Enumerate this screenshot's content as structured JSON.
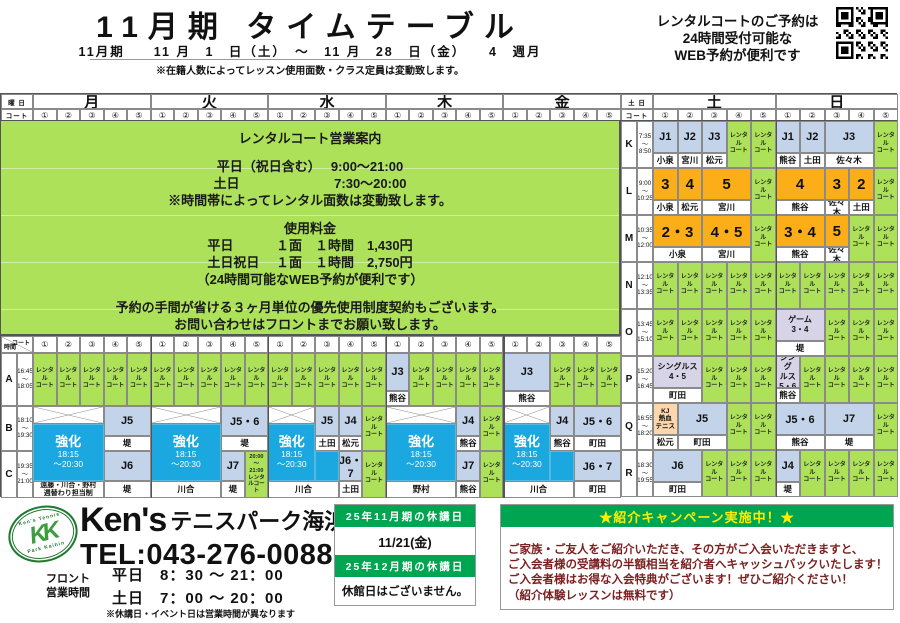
{
  "header": {
    "title": "11月期 タイムテーブル",
    "subtitle": "11月期　　11 月　1　日（土）　～　11 月　28　日（金）　　4　週月",
    "capacity_note": "※在籍人数によってレッスン使用面数・クラス定員は変動致します。",
    "web_note_lines": [
      "レンタルコートのご予約は",
      "24時間受付可能な",
      "WEB予約が便利です"
    ]
  },
  "table_header": {
    "corner_top": "曜 日",
    "corner_bottom": "コート",
    "weekdays": [
      "月",
      "火",
      "水",
      "木",
      "金"
    ],
    "weekend_corner": "土 日",
    "weekend_days": [
      "土",
      "日"
    ],
    "courts": [
      "①",
      "②",
      "③",
      "④",
      "⑤"
    ]
  },
  "green_info": {
    "lines": [
      "レンタルコート営業案内",
      "",
      "平日（祝日含む）　 9:00～21:00",
      "土日　　　　　　　 7:30～20:00",
      "※時間帯によってレンタル面数は変動致します。",
      "",
      "使用料金",
      "平日　　　 １面　１時間　1,430円",
      "土日祝日　 １面　１時間　2,750円",
      "（24時間可能なWEB予約が便利です）",
      "",
      "予約の手間が省ける３ヶ月単位の優先使用制度契約もございます。",
      "お問い合わせはフロントまでお願い致します。"
    ]
  },
  "weekend": {
    "rental_label": "レンタル|コート",
    "rows": [
      {
        "label": "K",
        "t1": "7:35",
        "t2": "8:50",
        "sat": [
          {
            "s": 1,
            "c": "class",
            "t": "J1",
            "n": "小泉"
          },
          {
            "s": 1,
            "c": "class",
            "t": "J2",
            "n": "宮川"
          },
          {
            "s": 1,
            "c": "class",
            "t": "J3",
            "n": "松元"
          },
          {
            "s": 1,
            "c": "rental"
          },
          {
            "s": 1,
            "c": "rental"
          }
        ],
        "sun": [
          {
            "s": 1,
            "c": "class",
            "t": "J1",
            "n": "熊谷"
          },
          {
            "s": 1,
            "c": "class",
            "t": "J2",
            "n": "土田"
          },
          {
            "s": 2,
            "c": "class",
            "t": "J3",
            "n": "佐々木"
          },
          {
            "s": 1,
            "c": "rental"
          }
        ]
      },
      {
        "label": "L",
        "t1": "9:00",
        "t2": "10:25",
        "sat": [
          {
            "s": 1,
            "c": "num",
            "t": "3",
            "n": "小泉"
          },
          {
            "s": 1,
            "c": "num",
            "t": "4",
            "n": "松元"
          },
          {
            "s": 2,
            "c": "num",
            "t": "5",
            "n": "宮川"
          },
          {
            "s": 1,
            "c": "rental"
          }
        ],
        "sun": [
          {
            "s": 2,
            "c": "num",
            "t": "4",
            "n": "熊谷"
          },
          {
            "s": 1,
            "c": "num",
            "t": "3",
            "n": "佐々木"
          },
          {
            "s": 1,
            "c": "num",
            "t": "2",
            "n": "土田"
          },
          {
            "s": 1,
            "c": "rental"
          }
        ]
      },
      {
        "label": "M",
        "t1": "10:35",
        "t2": "12:00",
        "sat": [
          {
            "s": 2,
            "c": "num",
            "t": "2・3",
            "n": "小泉"
          },
          {
            "s": 2,
            "c": "num",
            "t": "4・5",
            "n": "宮川"
          },
          {
            "s": 1,
            "c": "rental"
          }
        ],
        "sun": [
          {
            "s": 2,
            "c": "num",
            "t": "3・4",
            "n": "熊谷"
          },
          {
            "s": 1,
            "c": "num",
            "t": "5",
            "n": "佐々木"
          },
          {
            "s": 1,
            "c": "rental"
          },
          {
            "s": 1,
            "c": "rental"
          }
        ]
      },
      {
        "label": "N",
        "t1": "12:10",
        "t2": "13:35",
        "sat": [
          {
            "s": 1,
            "c": "rental"
          },
          {
            "s": 1,
            "c": "rental"
          },
          {
            "s": 1,
            "c": "rental"
          },
          {
            "s": 1,
            "c": "rental"
          },
          {
            "s": 1,
            "c": "rental"
          }
        ],
        "sun": [
          {
            "s": 1,
            "c": "rental"
          },
          {
            "s": 1,
            "c": "rental"
          },
          {
            "s": 1,
            "c": "rental"
          },
          {
            "s": 1,
            "c": "rental"
          },
          {
            "s": 1,
            "c": "rental"
          }
        ]
      },
      {
        "label": "O",
        "t1": "13:45",
        "t2": "15:10",
        "sat": [
          {
            "s": 1,
            "c": "rental"
          },
          {
            "s": 1,
            "c": "rental"
          },
          {
            "s": 1,
            "c": "rental"
          },
          {
            "s": 1,
            "c": "rental"
          },
          {
            "s": 1,
            "c": "rental"
          }
        ],
        "sun": [
          {
            "s": 2,
            "c": "game",
            "t": "ゲーム|3・4",
            "n": "堤"
          },
          {
            "s": 1,
            "c": "rental"
          },
          {
            "s": 1,
            "c": "rental"
          },
          {
            "s": 1,
            "c": "rental"
          }
        ]
      },
      {
        "label": "P",
        "t1": "15:20",
        "t2": "16:45",
        "sat": [
          {
            "s": 2,
            "c": "game",
            "t": "シングルス|4・5",
            "n": "町田"
          },
          {
            "s": 1,
            "c": "rental"
          },
          {
            "s": 1,
            "c": "rental"
          },
          {
            "s": 1,
            "c": "rental"
          }
        ],
        "sun": [
          {
            "s": 1,
            "c": "game",
            "t": "シング|ルス|5・6",
            "n": "熊谷"
          },
          {
            "s": 1,
            "c": "rental"
          },
          {
            "s": 1,
            "c": "rental"
          },
          {
            "s": 1,
            "c": "rental"
          },
          {
            "s": 1,
            "c": "rental"
          }
        ]
      },
      {
        "label": "Q",
        "t1": "16:55",
        "t2": "18:20",
        "sat": [
          {
            "s": 1,
            "c": "kj",
            "t": "KJ|熱血|テニス",
            "n": "松元"
          },
          {
            "s": 2,
            "c": "class",
            "t": "J5",
            "n": "町田"
          },
          {
            "s": 1,
            "c": "rental"
          },
          {
            "s": 1,
            "c": "rental"
          }
        ],
        "sun": [
          {
            "s": 2,
            "c": "class",
            "t": "J5・6",
            "n": "熊谷"
          },
          {
            "s": 2,
            "c": "class",
            "t": "J7",
            "n": "堤"
          },
          {
            "s": 1,
            "c": "rental"
          }
        ]
      },
      {
        "label": "R",
        "t1": "18:30",
        "t2": "19:55",
        "sat": [
          {
            "s": 2,
            "c": "class",
            "t": "J6",
            "n": "町田"
          },
          {
            "s": 1,
            "c": "rental"
          },
          {
            "s": 1,
            "c": "rental"
          },
          {
            "s": 1,
            "c": "rental"
          }
        ],
        "sun": [
          {
            "s": 1,
            "c": "class",
            "t": "J4",
            "n": "堤"
          },
          {
            "s": 1,
            "c": "rental"
          },
          {
            "s": 1,
            "c": "rental"
          },
          {
            "s": 1,
            "c": "rental"
          },
          {
            "s": 1,
            "c": "rental"
          }
        ]
      }
    ]
  },
  "bottom_table": {
    "corner_time": "時間",
    "corner_court": "コート",
    "kyoka_title": "強化",
    "kyoka_time": "18:15|～20:30",
    "rows": [
      {
        "label": "A",
        "t1": "16:45",
        "t2": "18:05"
      },
      {
        "label": "B",
        "t1": "18:10",
        "t2": "19:30"
      },
      {
        "label": "C",
        "t1": "19:35",
        "t2": "21:00"
      }
    ],
    "days": [
      {
        "day": "月",
        "a": [
          {
            "s": 1,
            "c": "rental"
          },
          {
            "s": 1,
            "c": "rental"
          },
          {
            "s": 1,
            "c": "rental"
          },
          {
            "s": 1,
            "c": "rental"
          },
          {
            "s": 1,
            "c": "rental"
          }
        ],
        "b": [
          {
            "s": 3,
            "c": "x"
          },
          {
            "s": 2,
            "c": "class",
            "t": "J5",
            "n": "堤"
          }
        ],
        "c": [
          {
            "s": 3,
            "c": "kyoka",
            "ext": 0,
            "n": "遠藤・川合・野村|週替わり担当制"
          },
          {
            "s": 2,
            "c": "class",
            "t": "J6",
            "n": "堤"
          }
        ]
      },
      {
        "day": "火",
        "a": [
          {
            "s": 1,
            "c": "rental"
          },
          {
            "s": 1,
            "c": "rental"
          },
          {
            "s": 1,
            "c": "rental"
          },
          {
            "s": 1,
            "c": "rental"
          },
          {
            "s": 1,
            "c": "rental"
          }
        ],
        "b": [
          {
            "s": 3,
            "c": "x"
          },
          {
            "s": 2,
            "c": "class",
            "t": "J5・6",
            "n": "堤"
          }
        ],
        "c": [
          {
            "s": 3,
            "c": "kyoka",
            "ext": 0,
            "n": "川合"
          },
          {
            "s": 1,
            "c": "class",
            "t": "J7",
            "n": "堤"
          },
          {
            "s": 1,
            "c": "rental_time",
            "t": "20:00|～|21:00|レンタルコート"
          }
        ]
      },
      {
        "day": "水",
        "a": [
          {
            "s": 1,
            "c": "rental"
          },
          {
            "s": 1,
            "c": "rental"
          },
          {
            "s": 1,
            "c": "rental"
          },
          {
            "s": 1,
            "c": "rental"
          },
          {
            "s": 1,
            "c": "rental"
          }
        ],
        "b": [
          {
            "s": 2,
            "c": "x"
          },
          {
            "s": 1,
            "c": "class",
            "t": "J5",
            "n": "土田"
          },
          {
            "s": 1,
            "c": "class",
            "t": "J4",
            "n": "松元"
          },
          {
            "s": 1,
            "c": "rental_b"
          }
        ],
        "c": [
          {
            "s": 2,
            "c": "kyoka",
            "ext": 1,
            "n": "川合"
          },
          {
            "s": 1,
            "c": "class",
            "t": "J6・7",
            "n": "土田"
          },
          {
            "s": 1,
            "c": "rental_c"
          }
        ]
      },
      {
        "day": "木",
        "a": [
          {
            "s": 1,
            "c": "class",
            "t": "J3",
            "n": "熊谷"
          },
          {
            "s": 1,
            "c": "rental"
          },
          {
            "s": 1,
            "c": "rental"
          },
          {
            "s": 1,
            "c": "rental"
          },
          {
            "s": 1,
            "c": "rental"
          }
        ],
        "b": [
          {
            "s": 3,
            "c": "x"
          },
          {
            "s": 1,
            "c": "class",
            "t": "J4",
            "n": "熊谷"
          },
          {
            "s": 1,
            "c": "rental_b"
          }
        ],
        "c": [
          {
            "s": 3,
            "c": "kyoka",
            "ext": 0,
            "n": "野村"
          },
          {
            "s": 1,
            "c": "class",
            "t": "J7",
            "n": "熊谷"
          },
          {
            "s": 1,
            "c": "rental_c"
          }
        ]
      },
      {
        "day": "金",
        "a": [
          {
            "s": 2,
            "c": "class",
            "t": "J3",
            "n": "熊谷"
          },
          {
            "s": 1,
            "c": "rental"
          },
          {
            "s": 1,
            "c": "rental"
          },
          {
            "s": 1,
            "c": "rental"
          }
        ],
        "b": [
          {
            "s": 2,
            "c": "x"
          },
          {
            "s": 1,
            "c": "class",
            "t": "J4",
            "n": "熊谷"
          },
          {
            "s": 2,
            "c": "class",
            "t": "J5・6",
            "n": "町田"
          }
        ],
        "c": [
          {
            "s": 2,
            "c": "kyoka",
            "ext": 1,
            "n": "川合"
          },
          {
            "s": 2,
            "c": "class",
            "t": "J6・7",
            "n": "町田"
          }
        ]
      }
    ]
  },
  "footer": {
    "brand1": "Ken's",
    "brand2": "テニスパーク",
    "brand3": "海浜幕張",
    "logo_kk": "KK",
    "logo_top": "Ken's Tennis",
    "logo_bottom": "Park Kaihin",
    "tel": "TEL:043-276-0088",
    "front_label": "フロント",
    "front_label2": "営業時間",
    "hours": [
      "平日　8：30 ～ 21：00",
      "土日　7：00 ～ 20：00"
    ],
    "hours_note": "※休講日・イベント日は営業時間が異なります",
    "holiday": {
      "h1": "25年11月期の休講日",
      "v1": "11/21(金)",
      "h2": "25年12月期の休講日",
      "v2": "休館日はございません。"
    },
    "campaign": {
      "title": "★紹介キャンペーン実施中！★",
      "lines": [
        "ご家族・ご友人をご紹介いただき、その方がご入会いただきますと、",
        "ご入会者様の受講料の半額相当を紹介者へキャッシュバックいたします！",
        "ご入会者様はお得な入会特典がございます！ぜひご紹介ください！",
        "（紹介体験レッスンは無料です）"
      ]
    }
  },
  "colors": {
    "green": "#ace159",
    "blue": "#c3d4ea",
    "orange": "#fbae17",
    "kyoka": "#1ba7e0",
    "lav": "#d8d4e8",
    "peach": "#fcd7ad",
    "hgreen": "#00a551",
    "cyellow": "#ffec00",
    "cred": "#7a1f1f"
  }
}
